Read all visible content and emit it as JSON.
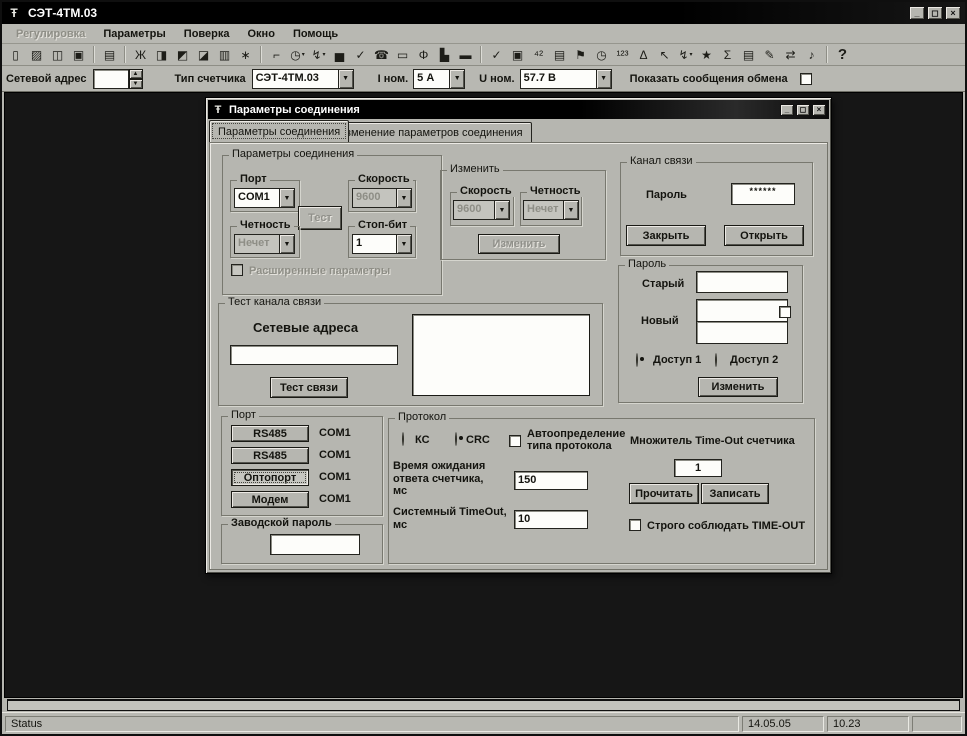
{
  "chrome": {
    "app_icon": "Ŧ",
    "minimize": "_",
    "maximize": "◻",
    "close": "×",
    "combo_arrow": "▼",
    "spin_up": "▲",
    "spin_down": "▼"
  },
  "window": {
    "title": "СЭТ-4ТМ.03"
  },
  "menu": {
    "items": [
      {
        "label": "Регулировка",
        "disabled": true
      },
      {
        "label": "Параметры"
      },
      {
        "label": "Поверка"
      },
      {
        "label": "Окно"
      },
      {
        "label": "Помощь"
      }
    ]
  },
  "toolbar": {
    "icons": [
      {
        "n": "new-document-icon",
        "g": "▯"
      },
      {
        "n": "open-file-icon",
        "g": "▨"
      },
      {
        "n": "save-icon",
        "g": "◫"
      },
      {
        "n": "save-report-icon",
        "g": "▣"
      },
      {
        "sep": true
      },
      {
        "n": "print-icon",
        "g": "▤"
      },
      {
        "sep": true
      },
      {
        "n": "scales-icon",
        "g": "Ж"
      },
      {
        "n": "meter-carriage-icon",
        "g": "◨"
      },
      {
        "n": "stand-icon",
        "g": "◩"
      },
      {
        "n": "meter-group-icon",
        "g": "◪"
      },
      {
        "n": "device-icon",
        "g": "▥"
      },
      {
        "n": "burst-icon",
        "g": "∗"
      },
      {
        "sep": true
      },
      {
        "n": "ruler-corner-icon",
        "g": "⌐"
      },
      {
        "n": "stopwatch-menu-icon",
        "g": "◷",
        "dd": true
      },
      {
        "n": "probe-menu-icon",
        "g": "↯",
        "dd": true
      },
      {
        "n": "bar-chart-icon",
        "g": "▅"
      },
      {
        "n": "chart-check-icon",
        "g": "✓"
      },
      {
        "n": "fax-icon",
        "g": "☎"
      },
      {
        "n": "window-icon",
        "g": "▭"
      },
      {
        "n": "info-icon",
        "g": "Φ"
      },
      {
        "n": "printer-device-icon",
        "g": "▙"
      },
      {
        "n": "display-icon",
        "g": "▬"
      },
      {
        "sep": true
      },
      {
        "n": "check-icon",
        "g": "✓"
      },
      {
        "n": "screen-icon",
        "g": "▣"
      },
      {
        "n": "adjust-counter-icon",
        "g": "⁴²"
      },
      {
        "n": "terminal-icon",
        "g": "▤"
      },
      {
        "n": "map-flag-icon",
        "g": "⚑"
      },
      {
        "n": "timer-icon",
        "g": "◷"
      },
      {
        "n": "digits-123-icon",
        "g": "¹²³"
      },
      {
        "n": "delta-icon",
        "g": "Δ"
      },
      {
        "n": "cursor-icon",
        "g": "↖"
      },
      {
        "n": "lightning-menu-icon",
        "g": "↯",
        "dd": true
      },
      {
        "n": "palette-icon",
        "g": "★"
      },
      {
        "n": "sigma-icon",
        "g": "Σ"
      },
      {
        "n": "journal-icon",
        "g": "▤"
      },
      {
        "n": "pen-icon",
        "g": "✎"
      },
      {
        "n": "exchange-icon",
        "g": "⇄"
      },
      {
        "n": "note-icon",
        "g": "♪"
      },
      {
        "sep": true
      },
      {
        "n": "help-icon",
        "g": "?",
        "cls": "big"
      }
    ]
  },
  "addrbar": {
    "net_address_label": "Сетевой адрес",
    "net_address_value": "",
    "meter_type_label": "Тип счетчика",
    "meter_type_value": "СЭТ-4ТМ.03",
    "inom_label": "I ном.",
    "inom_value": "5 А",
    "unom_label": "U ном.",
    "unom_value": "57.7 В",
    "show_messages_label": "Показать сообщения обмена"
  },
  "dialog": {
    "title": "Параметры соединения",
    "tabs": [
      {
        "label": "Параметры соединения"
      },
      {
        "label": "Изменение параметров соединения"
      }
    ],
    "conn_group": {
      "title": "Параметры соединения",
      "port_label": "Порт",
      "port_value": "COM1",
      "speed_label": "Скорость",
      "speed_value": "9600",
      "test_button": "Тест",
      "parity_label": "Четность",
      "parity_value": "Нечет",
      "stopbit_label": "Стоп-бит",
      "stopbit_value": "1",
      "extended_checkbox": "Расширенные параметры"
    },
    "change_group": {
      "title": "Изменить",
      "speed_label": "Скорость",
      "speed_value": "9600",
      "parity_label": "Четность",
      "parity_value": "Нечет",
      "change_button": "Изменить"
    },
    "channel_group": {
      "title": "Канал связи",
      "password_label": "Пароль",
      "password_value": "******",
      "close_button": "Закрыть",
      "open_button": "Открыть"
    },
    "password_group": {
      "title": "Пароль",
      "old_label": "Старый",
      "new_label": "Новый",
      "access1_label": "Доступ 1",
      "access2_label": "Доступ 2",
      "change_button": "Изменить"
    },
    "test_group": {
      "title": "Тест канала связи",
      "addresses_label": "Сетевые адреса",
      "address_value": "",
      "test_button": "Тест связи"
    },
    "port_group": {
      "title": "Порт",
      "buttons": [
        {
          "label": "RS485",
          "port": "COM1"
        },
        {
          "label": "RS485",
          "port": "COM1"
        },
        {
          "label": "Оптопорт",
          "port": "COM1"
        },
        {
          "label": "Модем",
          "port": "COM1"
        }
      ],
      "factory_password_title": "Заводской пароль",
      "factory_password_value": ""
    },
    "protocol_group": {
      "title": "Протокол",
      "kc_label": "КС",
      "crc_label": "CRC",
      "auto_label": "Автоопределение типа протокола",
      "wait_label": "Время ожидания ответа счетчика, мс",
      "wait_value": "150",
      "timeout_label": "Системный TimeOut, мс",
      "timeout_value": "10",
      "multiplier_label": "Множитель Time-Out счетчика",
      "multiplier_value": "1",
      "read_button": "Прочитать",
      "write_button": "Записать",
      "strict_label": "Строго соблюдать TIME-OUT"
    }
  },
  "statusbar": {
    "status": "Status",
    "date": "14.05.05",
    "time": "10.23"
  }
}
